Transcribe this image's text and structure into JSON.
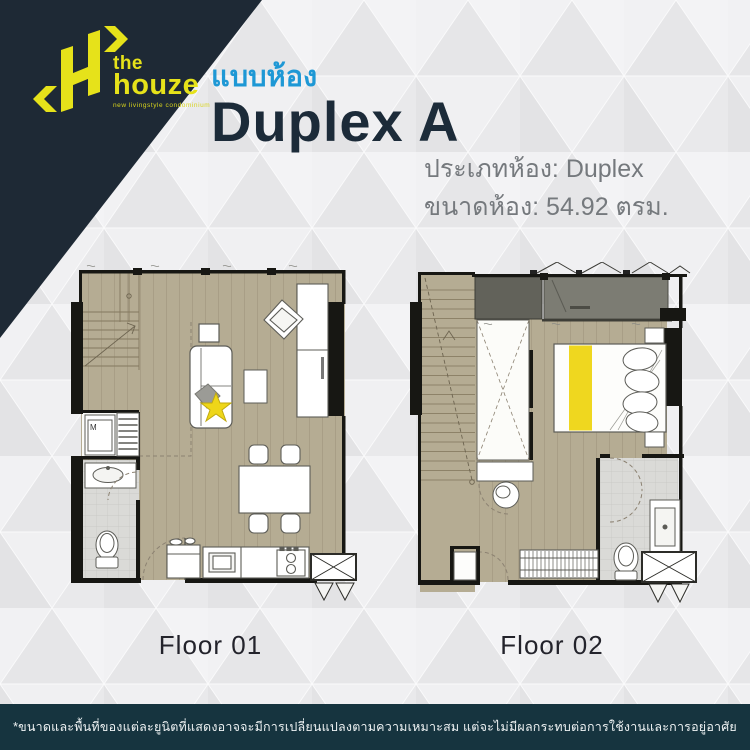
{
  "brand": {
    "name_line1": "the",
    "name_line2": "houze",
    "tagline": "new livingstyle condominium"
  },
  "header": {
    "subtitle": "แบบห้อง",
    "title": "Duplex A",
    "room_type": "ประเภทห้อง: Duplex",
    "room_size": "ขนาดห้อง: 54.92 ตรม."
  },
  "floor_plans": [
    {
      "label": "Floor 01",
      "washer_mark": "M"
    },
    {
      "label": "Floor 02"
    }
  ],
  "footer": {
    "disclaimer": "*ขนาดและพื้นที่ของแต่ละยูนิตที่แสดงอาจจะมีการเปลี่ยนแปลงตามความเหมาะสม แต่จะไม่มีผลกระทบต่อการใช้งานและการอยู่อาศัย"
  },
  "colors": {
    "brand_navy": "#1e2935",
    "brand_yellow": "#e6e21a",
    "accent_blue": "#1e98d5",
    "title_navy": "#1c2b39",
    "detail_gray": "#75797d",
    "footer_teal": "#16343f",
    "floor_tan": "#b5ac93",
    "highlight_yellow": "#efd71f"
  }
}
